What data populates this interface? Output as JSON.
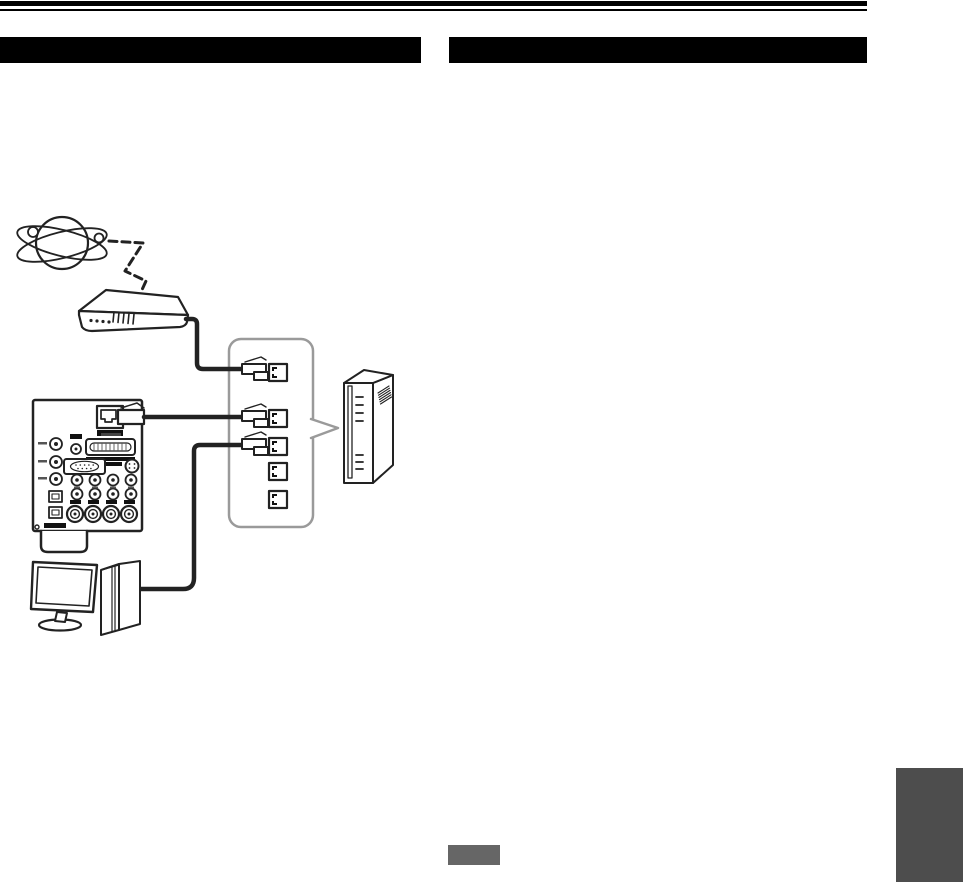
{
  "page": {
    "width": 963,
    "height": 882,
    "background": "#ffffff",
    "header": {
      "rule_color": "#000000",
      "left_bar": {
        "label": "",
        "color": "#000000"
      },
      "right_bar": {
        "label": "",
        "color": "#000000"
      }
    },
    "footer": {
      "page_badge": {
        "label": "",
        "color": "#666666"
      },
      "section_tab": {
        "label": "",
        "color": "#4d4d4d"
      }
    }
  },
  "diagram": {
    "stroke_color": "#222222",
    "callout_border_color": "#9a9a9a",
    "nodes": [
      {
        "id": "internet",
        "icon": "globe-orbit-icon",
        "label": ""
      },
      {
        "id": "modem",
        "icon": "modem-icon",
        "label": ""
      },
      {
        "id": "av-receiver-rear-panel",
        "icon": "receiver-rear-panel-icon",
        "label": "",
        "ethernet_port_label": ""
      },
      {
        "id": "ethernet-ports-callout",
        "icon": "ethernet-ports-icon",
        "ports_total": 5,
        "ports_connected": 3
      },
      {
        "id": "router",
        "icon": "router-tower-icon",
        "label": ""
      },
      {
        "id": "computer",
        "icon": "desktop-computer-icon",
        "label": ""
      }
    ],
    "connections": [
      {
        "from": "internet",
        "to": "modem",
        "style": "dashed"
      },
      {
        "from": "modem",
        "to": "port-1",
        "style": "solid"
      },
      {
        "from": "av-receiver-rear-panel",
        "to": "port-2",
        "style": "solid"
      },
      {
        "from": "computer",
        "to": "port-3",
        "style": "solid"
      }
    ]
  }
}
